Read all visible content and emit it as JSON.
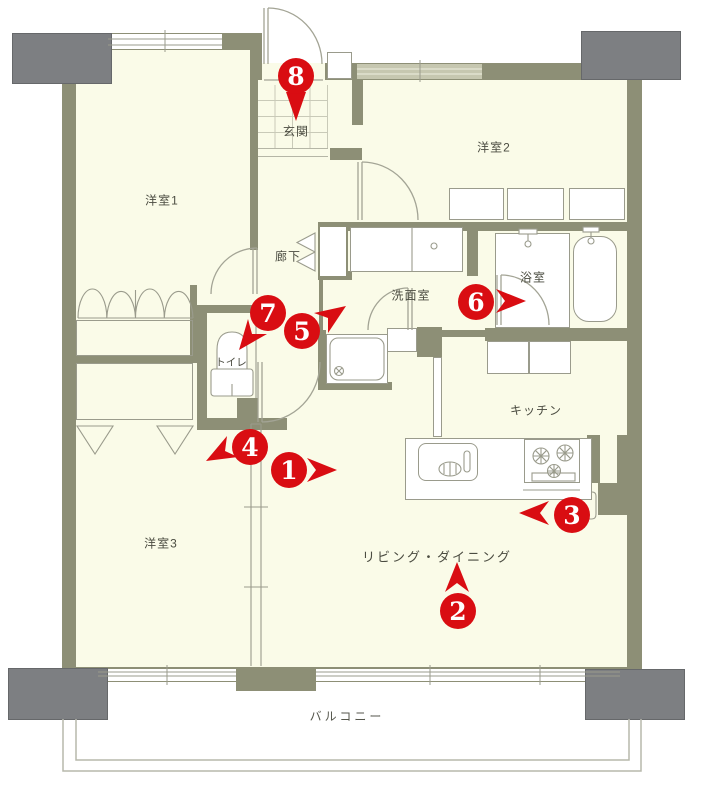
{
  "rooms": {
    "yoshitsu1": "洋室1",
    "yoshitsu2": "洋室2",
    "yoshitsu3": "洋室3",
    "genkan": "玄関",
    "rouka": "廊下",
    "toilet": "トイレ",
    "senmen": "洗面室",
    "yokushitsu": "浴室",
    "kitchen": "キッチン",
    "living": "リビング・ダイニング",
    "balcony": "バルコニー"
  },
  "markers": [
    {
      "label": "1",
      "arrow": "right"
    },
    {
      "label": "2",
      "arrow": "up"
    },
    {
      "label": "3",
      "arrow": "left"
    },
    {
      "label": "4",
      "arrow": "down-left"
    },
    {
      "label": "5",
      "arrow": "up-right"
    },
    {
      "label": "6",
      "arrow": "right"
    },
    {
      "label": "7",
      "arrow": "down-left"
    },
    {
      "label": "8",
      "arrow": "pin-down"
    }
  ],
  "colors": {
    "marker_red": "#d90d12",
    "wall_olive": "#8d8f76",
    "floor_cream": "#fafbe8",
    "pillar_gray": "#7d7f82"
  }
}
